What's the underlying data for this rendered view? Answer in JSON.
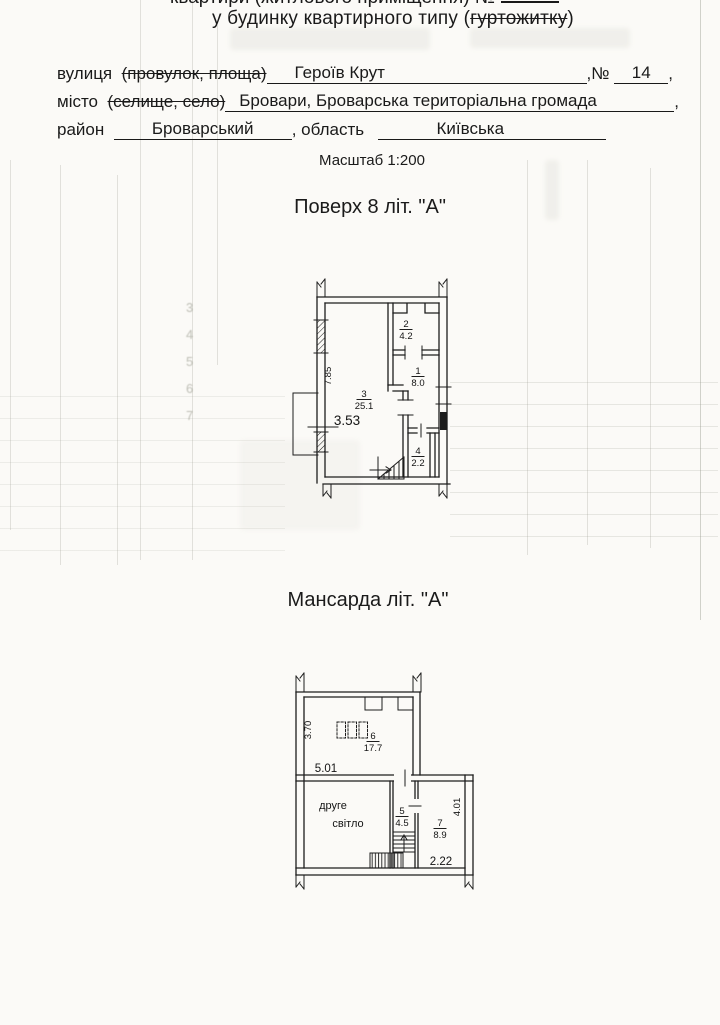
{
  "header": {
    "partial_top_line": "квартири (житлового приміщення) №",
    "building_line_prefix": "у будинку квартирного типу (",
    "building_line_struck": "гуртожитку",
    "building_line_suffix": ")"
  },
  "address": {
    "street_label": "вулиця",
    "street_struck": "(провулок, площа)",
    "street_value": "Героїв Крут",
    "num_label": ",№",
    "num_value": "14",
    "comma": ",",
    "city_label": "місто",
    "city_struck": "(селище, село)",
    "city_value": "Бровари, Броварська територіальна громада",
    "district_label": "район",
    "district_value": "Броварський",
    "oblast_label": ", область",
    "oblast_value": "Київська"
  },
  "scale_note": "Масштаб 1:200",
  "floor8": {
    "title": "Поверх 8 літ. \"А\"",
    "rooms": {
      "r1": {
        "num": "1",
        "area": "8.0"
      },
      "r2": {
        "num": "2",
        "area": "4.2"
      },
      "r3": {
        "num": "3",
        "area": "25.1"
      },
      "r4": {
        "num": "4",
        "area": "2.2"
      }
    },
    "dims": {
      "height": "7.85",
      "width": "3.53"
    }
  },
  "mansard": {
    "title": "Мансарда літ. \"А\"",
    "rooms": {
      "r5": {
        "num": "5",
        "area": "4.5"
      },
      "r6": {
        "num": "6",
        "area": "17.7"
      },
      "r7": {
        "num": "7",
        "area": "8.9"
      }
    },
    "dims": {
      "height_left": "3.70",
      "width_top": "5.01",
      "height_right": "4.01",
      "width_bottom": "2.22"
    },
    "void_line1": "друге",
    "void_line2": "світло"
  },
  "bleedthrough": {
    "rows": {
      "a": "3",
      "b": "4",
      "c": "5",
      "d": "6",
      "e": "7"
    }
  }
}
